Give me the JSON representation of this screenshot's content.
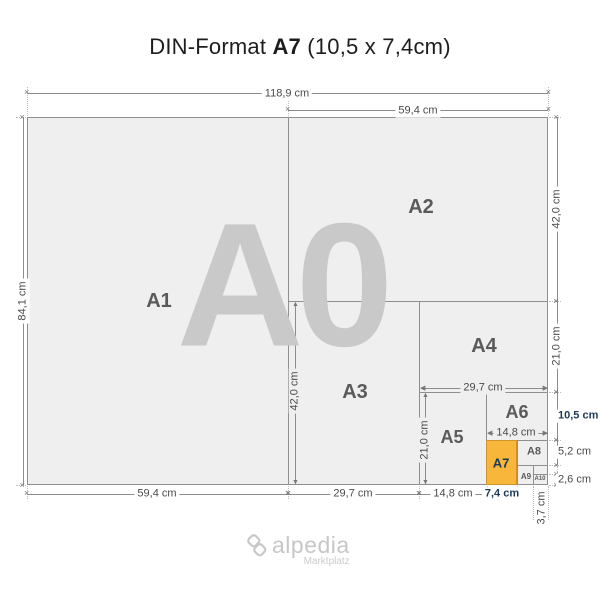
{
  "title": {
    "prefix": "DIN-Format ",
    "highlight": "A7",
    "suffix": " (10,5 x 7,4cm)"
  },
  "size_labels": {
    "a0": "A0",
    "a1": "A1",
    "a2": "A2",
    "a3": "A3",
    "a4": "A4",
    "a5": "A5",
    "a6": "A6",
    "a7": "A7",
    "a8": "A8",
    "a9": "A9",
    "a10": "A10"
  },
  "dims": {
    "total_width": "118,9 cm",
    "a2_width_top": "59,4 cm",
    "total_height": "84,1 cm",
    "a2_height": "42,0 cm",
    "a4_height": "21,0 cm",
    "a6_height": "10,5 cm",
    "a8_height": "5,2 cm",
    "a10_height": "2,6 cm",
    "a1_width": "59,4 cm",
    "a3_width": "29,7 cm",
    "a5_width": "14,8 cm",
    "a7_width": "7,4 cm",
    "a10_width": "3,7 cm",
    "a3_height_inner": "42,0 cm",
    "a5_height_inner": "21,0 cm",
    "a4_width_inner": "29,7 cm",
    "a6_width_inner": "14,8 cm"
  },
  "watermark": {
    "brand": "alpedia",
    "tagline": "Marktplatz"
  },
  "colors": {
    "highlight_fill": "#F8B63A",
    "highlight_border": "#D0942F",
    "highlight_text": "#1C3A57",
    "paper_fill": "#EFEFEF",
    "line": "#8C8C8C",
    "dim_text": "#4A4A4A",
    "size_label_text": "#5A5A5A",
    "watermark_gray": "#C9C9C9"
  }
}
